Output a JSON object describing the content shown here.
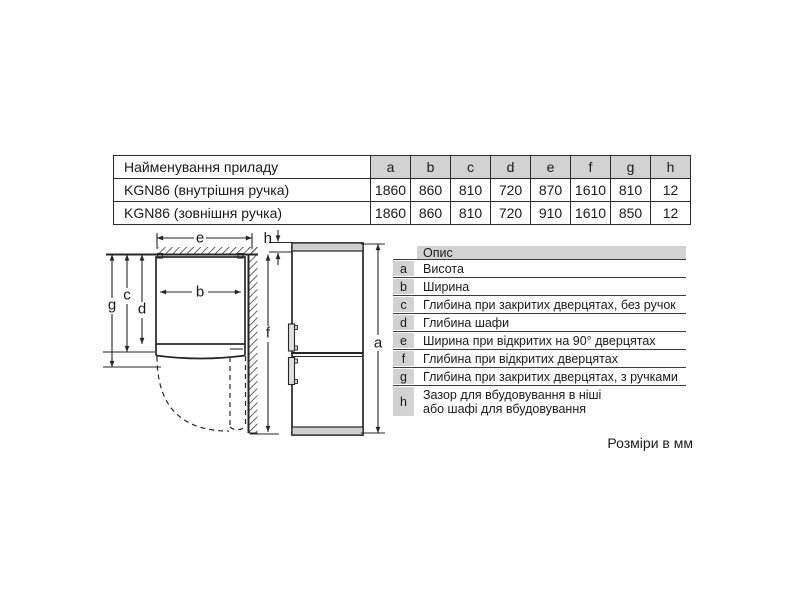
{
  "spec_table": {
    "name_header": "Найменування приладу",
    "columns": [
      "a",
      "b",
      "c",
      "d",
      "e",
      "f",
      "g",
      "h"
    ],
    "rows": [
      {
        "label": "KGN86 (внутрішня ручка)",
        "values": [
          "1860",
          "860",
          "810",
          "720",
          "870",
          "1610",
          "810",
          "12"
        ]
      },
      {
        "label": "KGN86 (зовнішня ручка)",
        "values": [
          "1860",
          "860",
          "810",
          "720",
          "910",
          "1610",
          "850",
          "12"
        ]
      }
    ]
  },
  "legend": {
    "header": "Опис",
    "rows": [
      {
        "key": "a",
        "desc": "Висота"
      },
      {
        "key": "b",
        "desc": "Ширина"
      },
      {
        "key": "c",
        "desc": "Глибина при закритих дверцятах, без ручок"
      },
      {
        "key": "d",
        "desc": "Глибина шафи"
      },
      {
        "key": "e",
        "desc": "Ширина при відкритих на 90° дверцятах"
      },
      {
        "key": "f",
        "desc": "Глибина при відкритих дверцятах"
      },
      {
        "key": "g",
        "desc": "Глибина при закритих дверцятах, з ручками"
      },
      {
        "key": "h",
        "desc_line1": "Зазор для вбудовування в ніші",
        "desc_line2": "або шафі для вбудовування"
      }
    ]
  },
  "diagram": {
    "labels": {
      "a": "a",
      "b": "b",
      "c": "c",
      "d": "d",
      "e": "e",
      "f": "f",
      "g": "g",
      "h": "h"
    }
  },
  "footnote": "Розміри в мм",
  "colors": {
    "fill_gray": "#d2d2d2",
    "line": "#262626"
  }
}
